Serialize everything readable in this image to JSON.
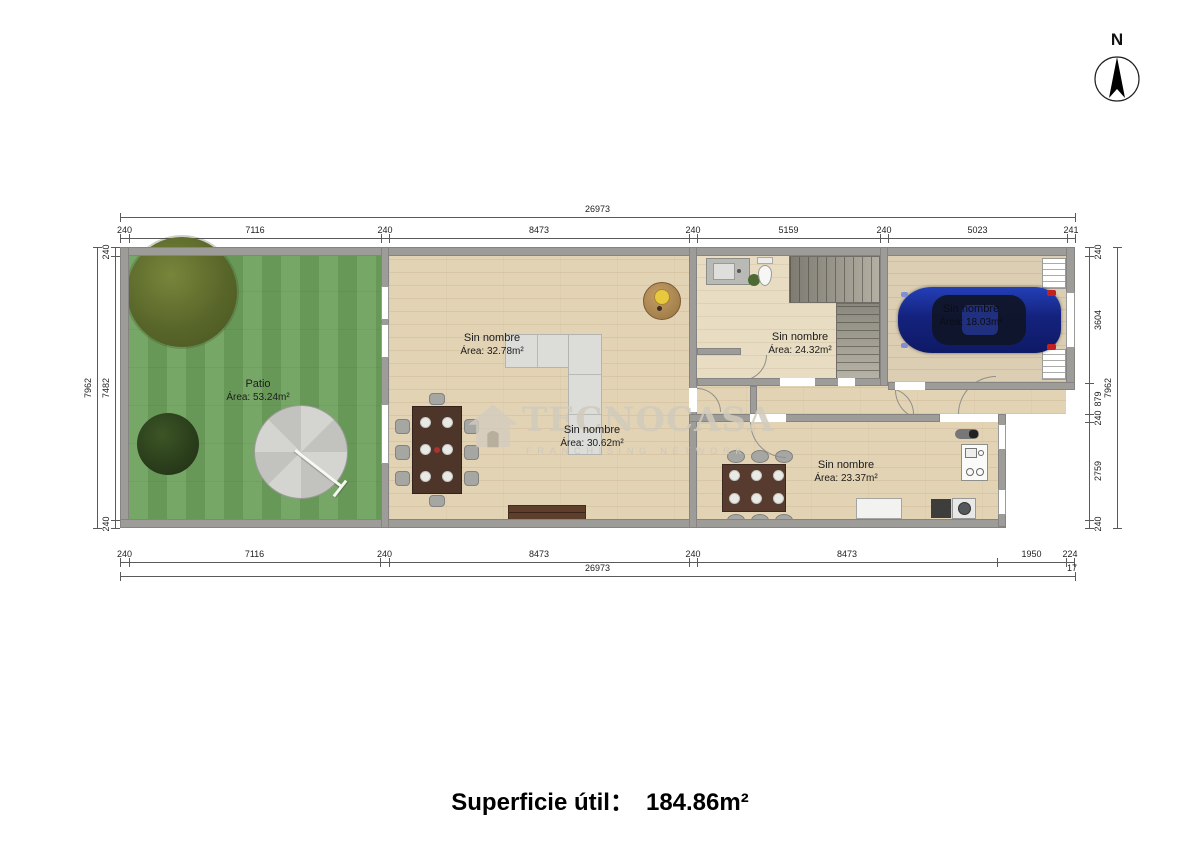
{
  "compass": {
    "north_label": "N"
  },
  "watermark": {
    "brand": "TECNOCASA",
    "subtitle": "FRANCHISING NETWORK"
  },
  "caption": {
    "label": "Superficie útil：",
    "value": "184.86m²"
  },
  "rooms": [
    {
      "name": "Patio",
      "area": "Área: 53.24m²"
    },
    {
      "name": "Sin nombre",
      "area": "Área: 32.78m²"
    },
    {
      "name": "Sin nombre",
      "area": "Área: 30.62m²"
    },
    {
      "name": "Sin nombre",
      "area": "Área: 24.32m²"
    },
    {
      "name": "Sin nombre",
      "area": "Área: 18.03m²"
    },
    {
      "name": "Sin nombre",
      "area": "Área: 23.37m²"
    }
  ],
  "dim_lines": [
    {
      "o": "h",
      "pos": 217,
      "b": [
        120,
        1075
      ],
      "labels": [
        "26973"
      ]
    },
    {
      "o": "h",
      "pos": 238,
      "b": [
        120,
        129,
        381,
        389,
        689,
        697,
        880,
        888,
        1067,
        1075
      ],
      "labels": [
        "240",
        "7116",
        "240",
        "8473",
        "240",
        "5159",
        "240",
        "5023",
        "241"
      ]
    },
    {
      "o": "h",
      "pos": 562,
      "b": [
        120,
        129,
        380,
        389,
        689,
        697,
        997,
        1066,
        1074
      ],
      "labels": [
        "240",
        "7116",
        "240",
        "8473",
        "240",
        "8473",
        "1950",
        "224"
      ]
    },
    {
      "o": "h",
      "pos": 576,
      "b": [
        120,
        1075
      ],
      "labels": [
        "26973"
      ]
    },
    {
      "o": "v",
      "pos": 115,
      "side": "left",
      "b": [
        247,
        256,
        520,
        528
      ],
      "labels": [
        "240",
        "7482",
        "240"
      ]
    },
    {
      "o": "v",
      "pos": 97,
      "side": "left",
      "b": [
        247,
        528
      ],
      "labels": [
        "7962"
      ]
    },
    {
      "o": "v",
      "pos": 1089,
      "side": "right",
      "b": [
        247,
        256,
        383,
        414,
        422,
        520,
        528
      ],
      "labels": [
        "240",
        "3604",
        "879",
        "240",
        "2759",
        "240"
      ]
    },
    {
      "o": "v",
      "pos": 1117,
      "side": "left",
      "b": [
        247,
        528
      ],
      "labels": [
        "7962"
      ]
    }
  ],
  "dim_extra": [
    {
      "text": "17",
      "x": 1072,
      "y": 563
    }
  ],
  "colors": {
    "wall": "#9e9c99",
    "grass": "#6fa25e",
    "wood": "#e3d3b5",
    "car": "#1c2f96",
    "dim_line": "#5a5a5a"
  }
}
